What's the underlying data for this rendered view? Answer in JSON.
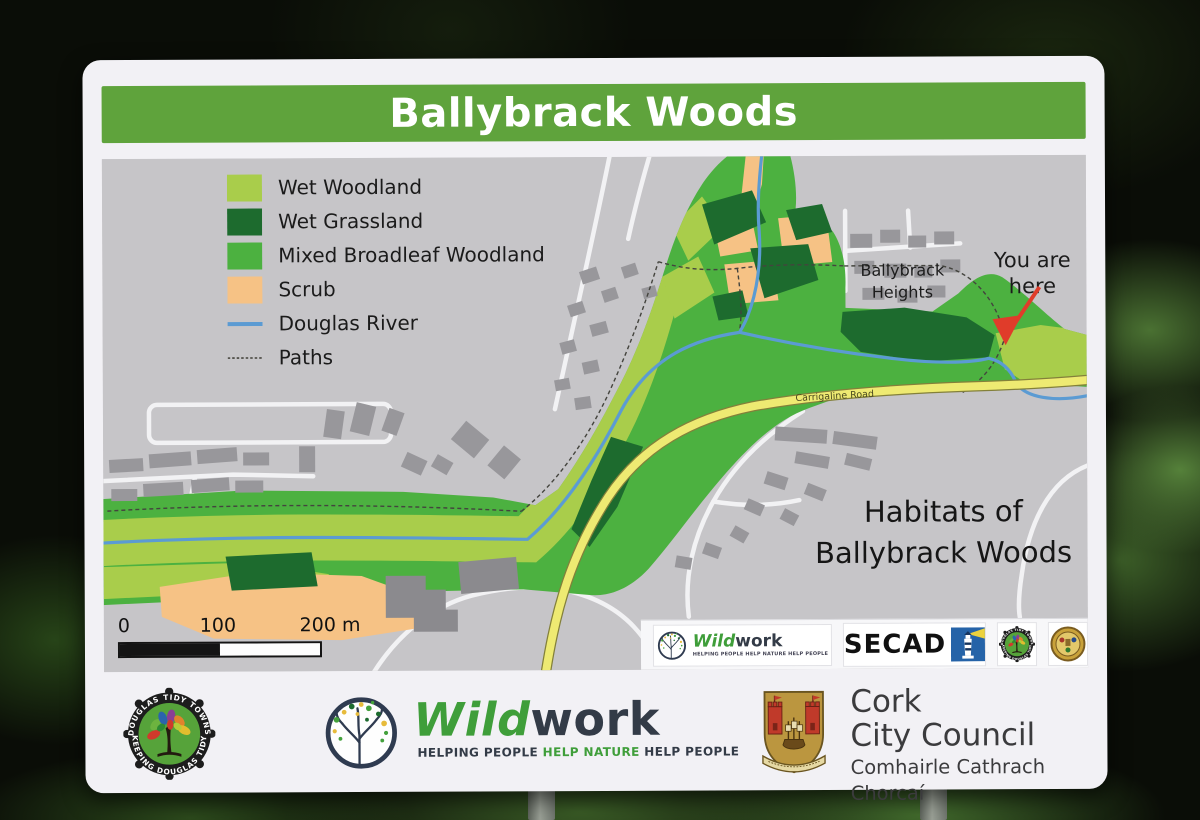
{
  "sign": {
    "title": "Ballybrack Woods",
    "map": {
      "legend": [
        {
          "label": "Wet Woodland",
          "color": "#a9cd4b"
        },
        {
          "label": "Wet Grassland",
          "color": "#1d6b2e"
        },
        {
          "label": "Mixed Broadleaf Woodland",
          "color": "#4cb140"
        },
        {
          "label": "Scrub",
          "color": "#f6c285"
        },
        {
          "label": "Douglas River",
          "color": "#5b9bd3"
        },
        {
          "label": "Paths",
          "color": "#55544e"
        }
      ],
      "labels": {
        "estate_line1": "Ballybrack",
        "estate_line2": "Heights",
        "here_line1": "You are",
        "here_line2": "here",
        "road": "Carrigaline Road",
        "caption_line1": "Habitats of",
        "caption_line2": "Ballybrack Woods"
      },
      "scale": {
        "t0": "0",
        "t1": "100",
        "t2": "200 m"
      },
      "strip": {
        "wild": "Wild",
        "work": "work",
        "tagline": "HELPING PEOPLE HELP NATURE HELP PEOPLE",
        "secad": "SECAD"
      }
    },
    "footer": {
      "tidy": {
        "arc_top": "DOUGLAS TIDY TOWNS",
        "arc_bottom": "KEEPING DOUGLAS TIDY"
      },
      "wildwork": {
        "wild": "Wild",
        "work": "work",
        "tag_pre": "HELPING PEOPLE ",
        "tag_mid": "HELP NATURE",
        "tag_post": " HELP PEOPLE"
      },
      "council": {
        "line1": "Cork",
        "line2": "City Council",
        "line3": "Comhairle Cathrach Chorcaí"
      }
    }
  }
}
